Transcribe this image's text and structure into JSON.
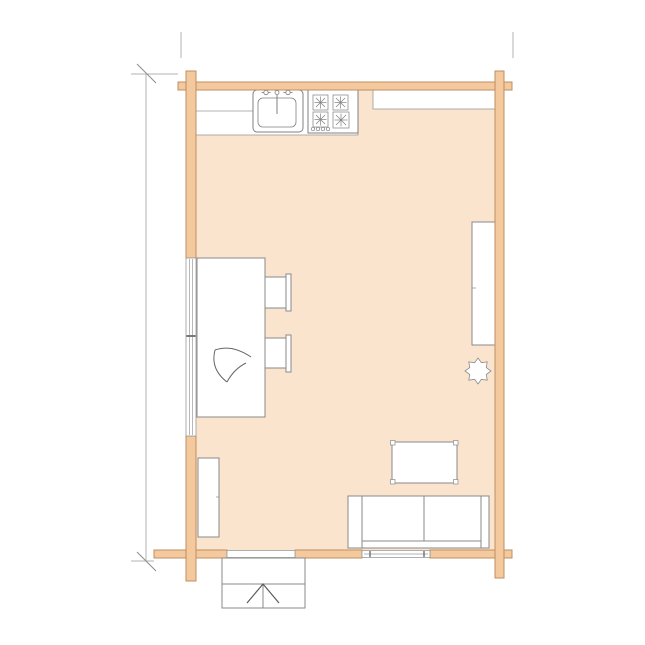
{
  "document": {
    "title": "log-cabin-floor-plan",
    "background": "#ffffff",
    "visible_text": []
  },
  "colors": {
    "wall_fill": "#f3c99d",
    "wall_stroke": "#bd9062",
    "floor_fill": "#fae4ce",
    "furniture_fill": "#ffffff",
    "furniture_stroke": "#8a8a8a",
    "fixture_stroke": "#808080",
    "counter_stroke": "#9a9a9a",
    "glazing_stroke": "#9a9a9a",
    "window_tick": "#777777",
    "door_leaf_stroke": "#595959",
    "door_swing_stroke": "#9b9b9b",
    "steps_stroke": "#8a8a8a",
    "stair_arrow_stroke": "#595959",
    "sketch_mark_stroke": "#666666",
    "dimension_stroke": "#b3b3b3",
    "dimension_tick_stroke": "#8f8f8f"
  },
  "plan": {
    "structure": [
      "left-wall",
      "top-wall",
      "right-wall",
      "bottom-wall"
    ],
    "openings": [
      "left-window",
      "bottom-window",
      "entry-door"
    ],
    "kitchen_fixtures": [
      "kitchen-counter",
      "kitchen-sink",
      "cooktop",
      "kitchen-shelf"
    ],
    "furniture": [
      "dining-table",
      "chair-top",
      "chair-bottom",
      "wardrobe",
      "plant",
      "coffee-table",
      "sofa",
      "low-cabinet"
    ],
    "outside": [
      "entry-steps"
    ],
    "annotations": [
      "left-dimension-line",
      "top-extension-line-left",
      "top-extension-line-right"
    ]
  }
}
